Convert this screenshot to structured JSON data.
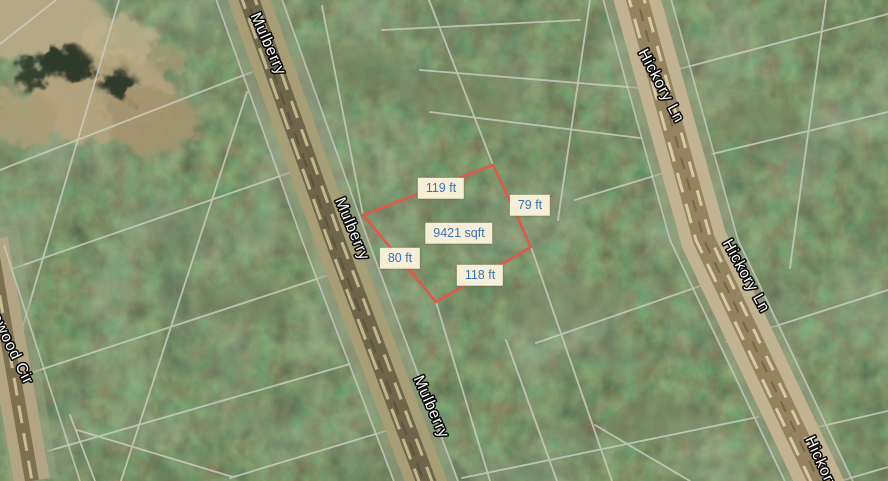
{
  "map": {
    "parcel": {
      "area": "9421 sqft",
      "side_nw": "119 ft",
      "side_ne": "79 ft",
      "side_se": "118 ft",
      "side_sw": "80 ft"
    },
    "roads": {
      "mulberry_top": "Mulberry",
      "mulberry_mid": "Mulberry",
      "mulberry_bottom": "Mulberry",
      "hickory_top": "Hickory Ln",
      "hickory_mid": "Hickory Ln",
      "hickory_bottom_partial": "Hickory",
      "circle_left_partial": "awood Cir"
    },
    "colors": {
      "parcel_outline": "#dd5a49",
      "measurement_bg": "#f6eed6",
      "measurement_text": "#3b72b4",
      "road_label_fill": "#ffffff",
      "road_label_outline": "#0a0a0a",
      "lot_line": "#c9ccbf"
    }
  }
}
